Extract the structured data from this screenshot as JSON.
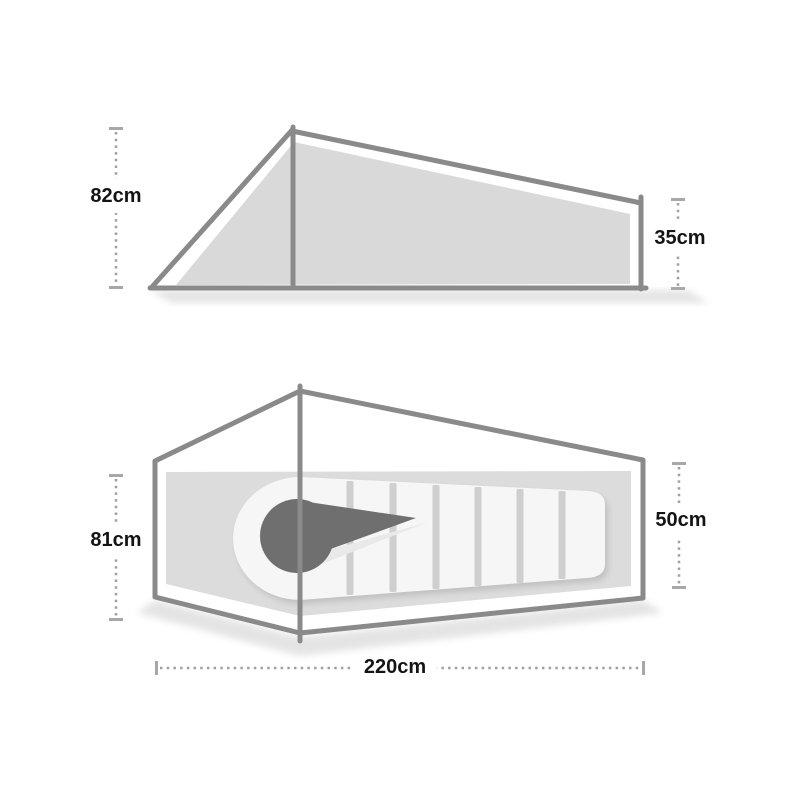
{
  "diagram": {
    "subject": "tent-dimensions-diagram",
    "side_view": {
      "name": "tent-side-view",
      "dims": {
        "left_height": "82cm",
        "right_height": "35cm"
      }
    },
    "top_view": {
      "name": "tent-top-view",
      "dims": {
        "left_width": "81cm",
        "right_width": "50cm",
        "length": "220cm"
      }
    },
    "colors": {
      "background": "#ffffff",
      "frame_outline": "#8a8a8a",
      "fabric_fill": "#d9d9d9",
      "floor_fill": "#dcdcdc",
      "sleeping_bag": "#f6f6f6",
      "baffle_stripe": "#cfcfcf",
      "hood": "#6f6f6f",
      "fold": "#e9e9e9",
      "dimension_line": "#a0a0a0",
      "label_text": "#141414"
    }
  }
}
